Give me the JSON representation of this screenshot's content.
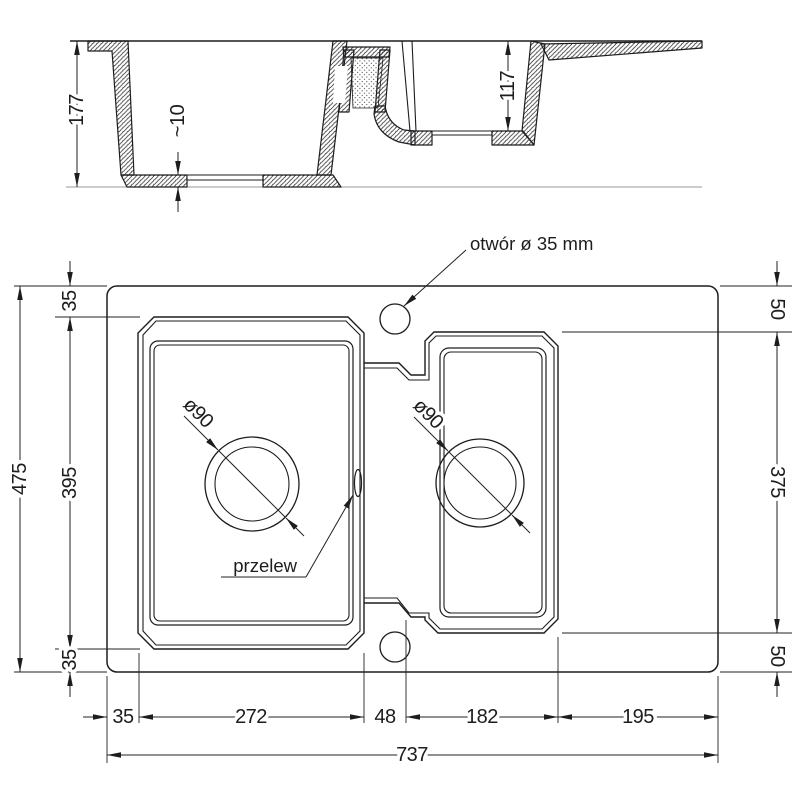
{
  "drawing": {
    "type": "kitchen sink technical dimension drawing",
    "units": "mm"
  },
  "section_view": {
    "depth_left": "177",
    "bottom_step": "~10",
    "depth_right": "117"
  },
  "plan_view": {
    "tap_hole_label": "otwór ø 35 mm",
    "overflow_label": "przelew",
    "drain_left": "ø90",
    "drain_right": "ø90",
    "left": {
      "total": "475",
      "top_margin": "35",
      "bowl_span": "395",
      "bottom_margin": "35"
    },
    "right": {
      "top_edge": "50",
      "inner_span": "375",
      "bottom_edge": "50"
    },
    "bottom": {
      "left_margin": "35",
      "bowl1_width": "272",
      "divider_gap": "48",
      "bowl2_width": "182",
      "drainer_width": "195",
      "total": "737"
    }
  },
  "colors": {
    "line": "#1d1d20",
    "dimension": "#222222",
    "ground_line": "#9a9a9a",
    "background": "#ffffff"
  }
}
